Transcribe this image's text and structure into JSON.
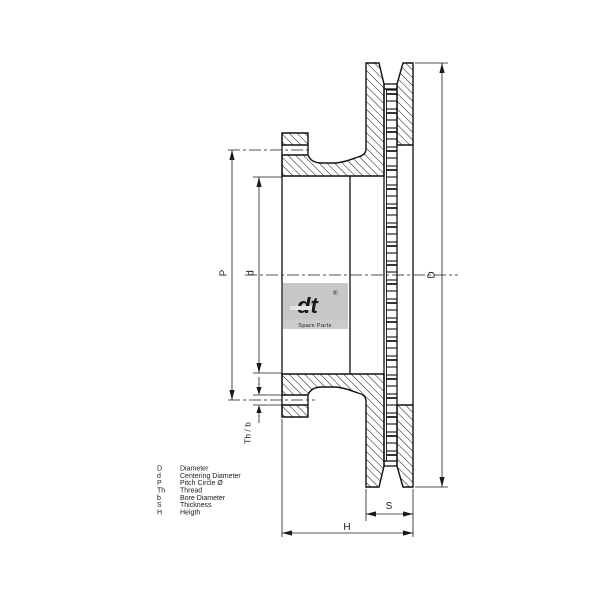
{
  "diagram": {
    "dimensions": {
      "D": "D",
      "P": "P",
      "d": "d",
      "thb": "Th / b",
      "S": "S",
      "H": "H"
    },
    "legend": [
      {
        "symbol": "D",
        "label": "Diameter"
      },
      {
        "symbol": "d",
        "label": "Centering Diameter"
      },
      {
        "symbol": "P",
        "label": "Pitch Circle Ø"
      },
      {
        "symbol": "Th",
        "label": "Thread"
      },
      {
        "symbol": "b",
        "label": "Bore Diameter"
      },
      {
        "symbol": "S",
        "label": "Thickness"
      },
      {
        "symbol": "H",
        "label": "Heigth"
      }
    ],
    "watermark": {
      "logo": "dt",
      "registered": "®",
      "caption": "Spare Parts"
    },
    "colors": {
      "line": "#111111",
      "dimension_line": "#1a1a1a",
      "watermark_bg": "#c7c7c7",
      "watermark_fg": "#e3e3e3",
      "watermark_text": "#a8a8a8"
    }
  }
}
